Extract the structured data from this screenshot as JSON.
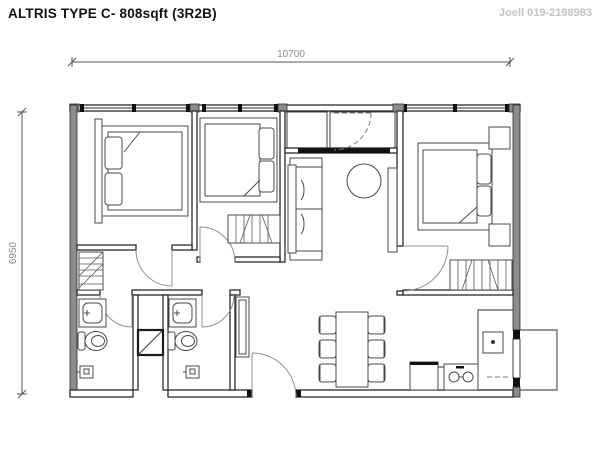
{
  "header": {
    "title": "ALTRIS TYPE C- 808sqft (3R2B)",
    "agent_contact": "Joell 019-2198983"
  },
  "dimensions": {
    "width_label": "10700",
    "height_label": "6950"
  },
  "plan": {
    "type": "apartment-floor-plan",
    "rooms": [
      "bedroom-1",
      "bedroom-2",
      "bedroom-3",
      "living-area",
      "dining-area",
      "kitchen",
      "bathroom-1",
      "bathroom-2",
      "entrance-foyer",
      "corridor",
      "ac-ledge",
      "yard",
      "shaft"
    ],
    "furniture": [
      "double-bed-1",
      "double-bed-2",
      "double-bed-3",
      "wardrobe-1",
      "wardrobe-2",
      "wardrobe-3",
      "corridor-closet",
      "sofa",
      "coffee-table",
      "tv-console",
      "dining-table",
      "dining-chairs-x6",
      "nightstand-x2",
      "basin-1",
      "toilet-1",
      "shower-1",
      "basin-2",
      "toilet-2",
      "shower-2",
      "kitchen-counter",
      "stove",
      "kitchen-sink",
      "appliance",
      "entrance-cabinet"
    ]
  },
  "colors": {
    "wall_line": "#2b2b2b",
    "wall_fill": "#8c8c8c",
    "furniture_line": "#4a4a4a",
    "door_arc": "#8f8f8f",
    "dimension_text": "#8a8a8a",
    "agent_text": "#c2c2c2",
    "title_text": "#111111"
  }
}
